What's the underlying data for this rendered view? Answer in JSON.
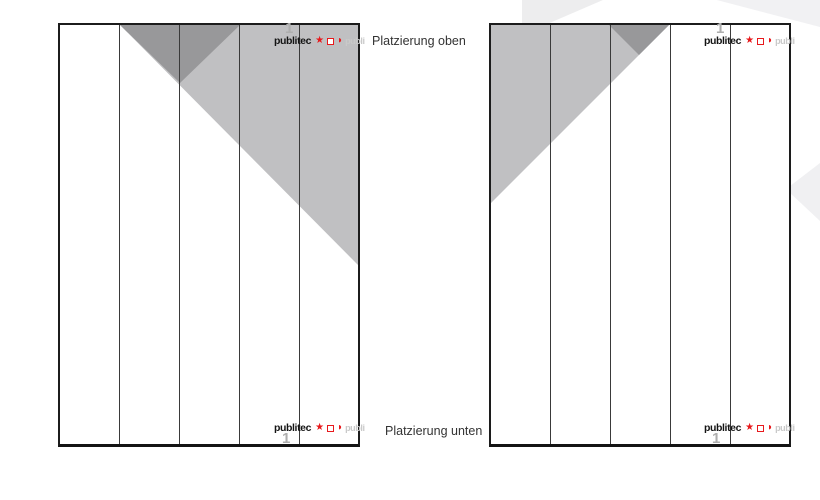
{
  "labels": {
    "placement_top": "Platzierung oben",
    "placement_bottom": "Platzierung unten"
  },
  "logo": {
    "text": "publitec",
    "star_char": "★",
    "square_icon": "red-outline-square",
    "halfcircle_char": "◗",
    "ghost_text": "publi",
    "marker": "1"
  },
  "pages": {
    "left": {
      "columns": 5,
      "ad_shapes": [
        {
          "name": "large-light-triangle",
          "color": "#c0c0c2",
          "corner": "top-right",
          "width_cols": 4,
          "depth_px": 240
        },
        {
          "name": "small-dark-triangle",
          "color": "#98989a",
          "span_cols": "2-3",
          "depth_px": 58
        }
      ]
    },
    "right": {
      "columns": 5,
      "ad_shapes": [
        {
          "name": "large-light-triangle",
          "color": "#c0c0c2",
          "corner": "top-left",
          "width_cols": 3,
          "depth_px": 178
        },
        {
          "name": "small-dark-triangle",
          "color": "#98989a",
          "span_cols": "3",
          "depth_px": 30
        }
      ]
    }
  },
  "colors": {
    "light_gray": "#c0c0c2",
    "dark_gray": "#98989a",
    "logo_red": "#e8191c",
    "column_line": "#3a3a3a",
    "page_border": "#1c1c1c",
    "marker_gray": "#aeaeae",
    "label_text": "#333333",
    "watermark": "#efeff1"
  }
}
